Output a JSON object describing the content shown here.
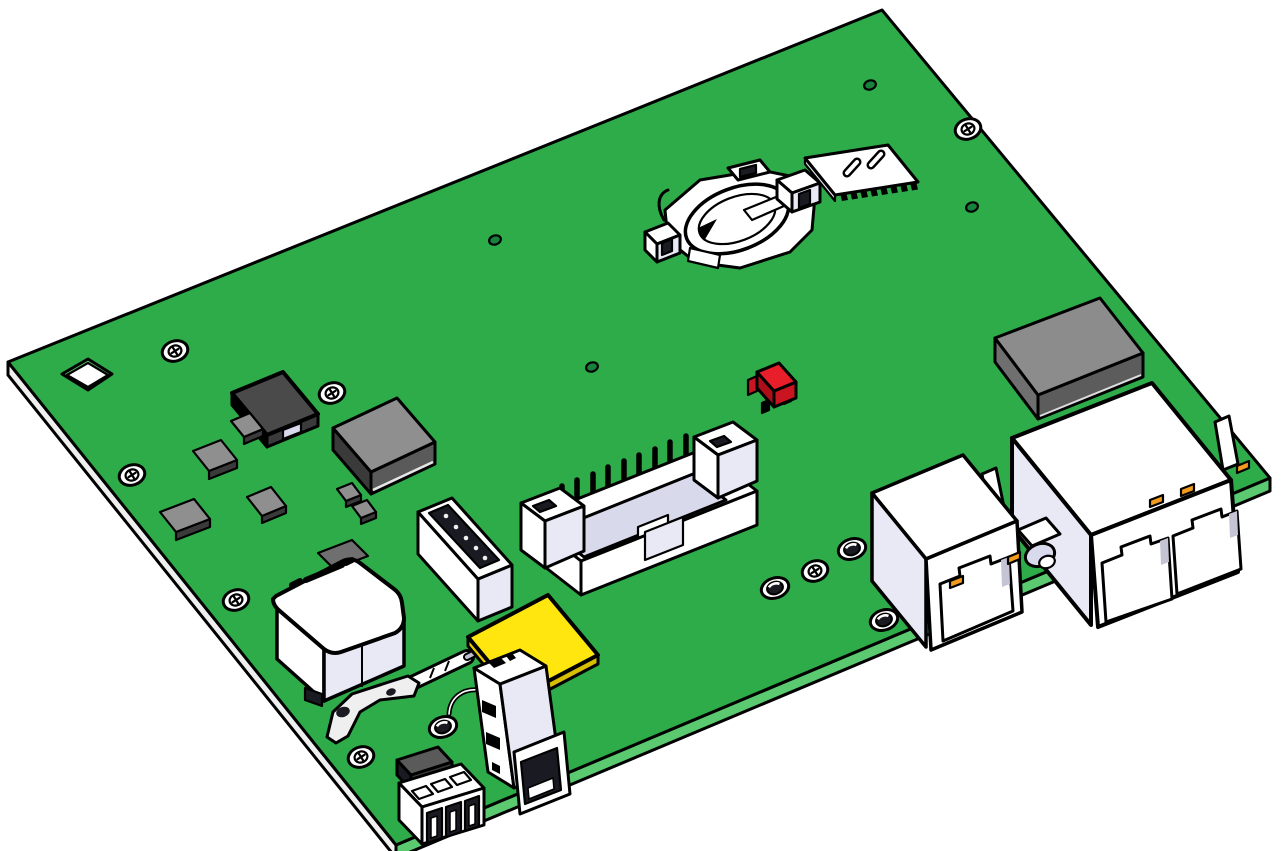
{
  "scene": {
    "description": "3D CAD rendering of a green printed circuit board assembly viewed at an angle on a white background"
  },
  "colors": {
    "outline": "#000000",
    "board_green": "#2EAC49",
    "board_side_light": "#5BC970",
    "board_side_white": "#EFEFEF",
    "comp_white": "#FFFFFF",
    "shade_lav": "#E9E9F6",
    "shade_lav2": "#D9D9EC",
    "chip_gray": "#8F8F8F",
    "chip_side": "#5A5A5A",
    "chip_dark": "#3A3A3A",
    "module_gray": "#8C8C8C",
    "module_side_sw": "#6F6F6F",
    "module_side_se": "#5C5C5C",
    "inductor_top": "#4A4A4A",
    "red_top": "#E81F2A",
    "red_sw": "#AD0F19",
    "red_se": "#C81520",
    "yellow_top": "#FFE60E",
    "yellow_sw": "#E8CC00",
    "yellow_se": "#D8BE00",
    "orange_led": "#F29B1D",
    "via_green": "#18813B",
    "dark_slot": "#1A1A22",
    "gray_wedge": "#C4C4D4"
  },
  "components": [
    {
      "name": "pcb-board",
      "label": "Green PCB"
    },
    {
      "name": "corner-cutout",
      "label": "Square cutout hole"
    },
    {
      "name": "mounting-screw",
      "label": "Mounting screw",
      "count": 7
    },
    {
      "name": "standoff-grommet",
      "label": "Standoff post",
      "count": 4
    },
    {
      "name": "via-hole",
      "label": "Via hole",
      "count": 4
    },
    {
      "name": "power-inductor",
      "label": "Power inductor"
    },
    {
      "name": "smd-chip",
      "label": "SMD chip",
      "count": 6
    },
    {
      "name": "main-ic",
      "label": "Main IC chip"
    },
    {
      "name": "coin-cell-holder",
      "label": "Coin cell battery holder"
    },
    {
      "name": "sim-card-socket",
      "label": "SIM card socket"
    },
    {
      "name": "shield-module",
      "label": "Gray shield module"
    },
    {
      "name": "red-jumper",
      "label": "Red jumper block"
    },
    {
      "name": "idc-box-header",
      "label": "Shrouded pin header"
    },
    {
      "name": "female-header",
      "label": "Female pin header"
    },
    {
      "name": "buzzer",
      "label": "Buzzer with part marking"
    },
    {
      "name": "metal-bracket",
      "label": "Metal bracket with holes"
    },
    {
      "name": "antenna-rod",
      "label": "Antenna rod connector"
    },
    {
      "name": "yellow-pad",
      "label": "Yellow card pad"
    },
    {
      "name": "usb-a-port",
      "label": "USB-A port, vertical"
    },
    {
      "name": "terminal-block",
      "label": "3-pin connector"
    },
    {
      "name": "rj45-single",
      "label": "Single RJ45 jack with LEDs"
    },
    {
      "name": "rj45-dual",
      "label": "Dual RJ45 jack with LEDs"
    },
    {
      "name": "barrel-connector",
      "label": "Small barrel connector"
    }
  ]
}
